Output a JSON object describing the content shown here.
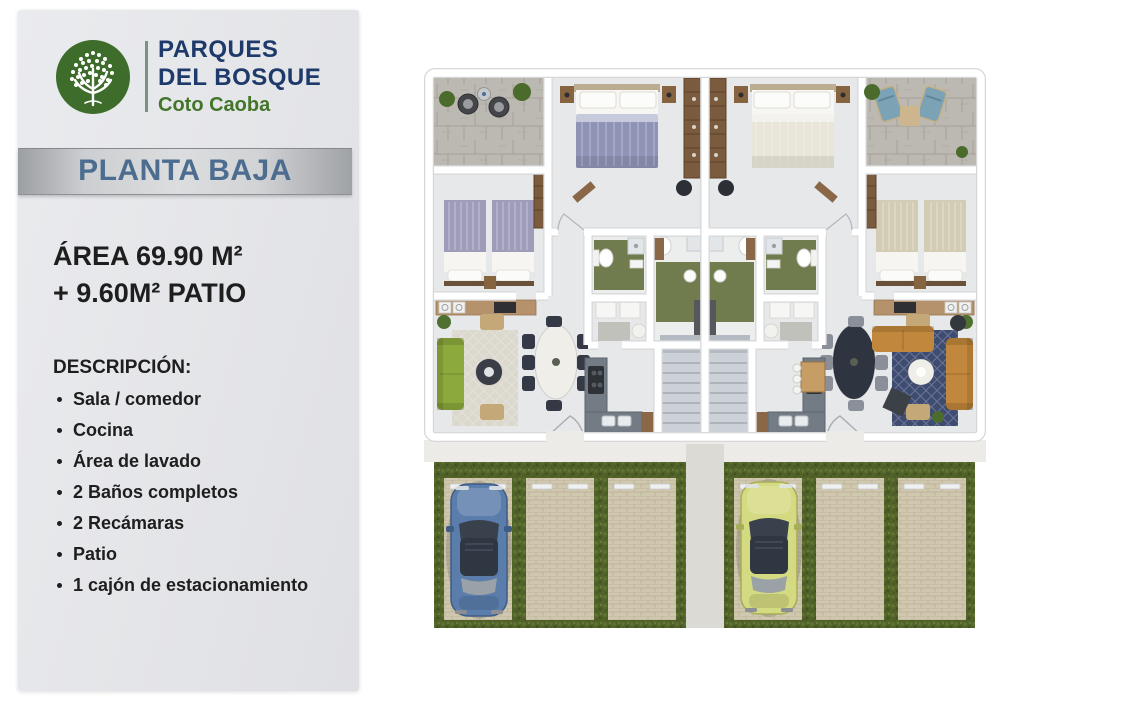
{
  "panel": {
    "logo": {
      "icon": "tree-icon",
      "line1": "PARQUES",
      "line2": "DEL BOSQUE",
      "subtitle": "Coto Caoba"
    },
    "banner_title": "PLANTA BAJA",
    "area": {
      "line1": "ÁREA 69.90 M²",
      "line2": "+ 9.60M² PATIO"
    },
    "description": {
      "heading": "DESCRIPCIÓN:",
      "items": [
        "Sala / comedor",
        "Cocina",
        "Área de lavado",
        "2 Baños completos",
        "2 Recámaras",
        "Patio",
        "1 cajón de estacionamiento"
      ]
    }
  },
  "floorplan": {
    "view": "top-down-render",
    "units": 2,
    "parking_spots": 6,
    "cars": [
      {
        "name": "car-blue",
        "color": "#5b7dab"
      },
      {
        "name": "car-green",
        "color": "#d4da82"
      }
    ]
  },
  "colors": {
    "brand-navy": "#1e3a6b",
    "brand-green": "#44752b",
    "banner-text": "#4c6d90",
    "text": "#1e1e1e",
    "car-blue": "#5b7dab",
    "car-green": "#d4da82",
    "sofa-left": "#8ca93c",
    "sofa-right": "#c1873c",
    "rug-left": "#dbd8ce",
    "rug-right": "#3f4c72"
  }
}
